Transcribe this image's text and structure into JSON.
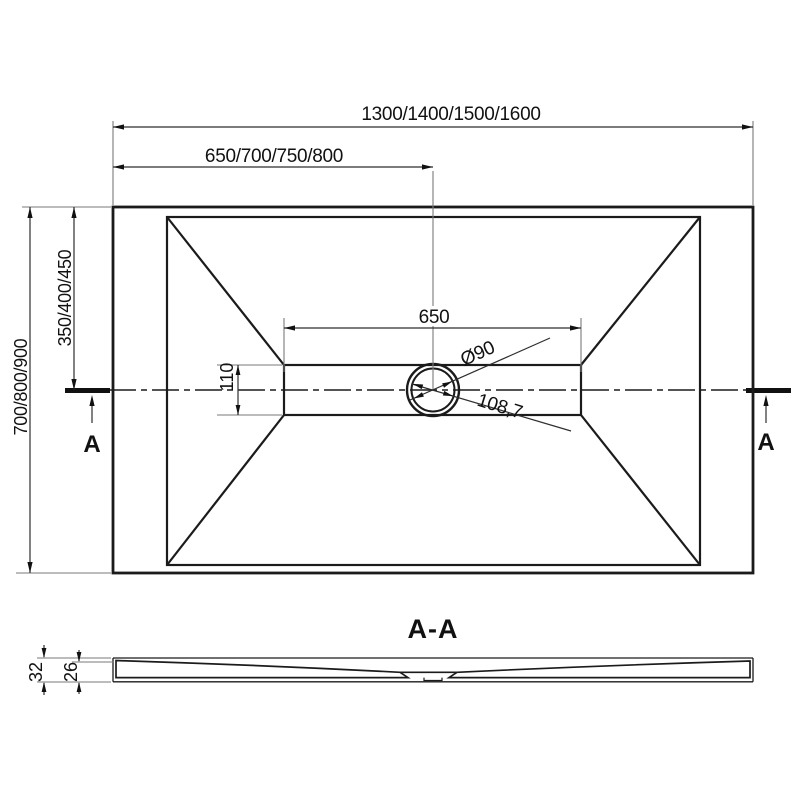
{
  "top_view": {
    "overall_width": "1300/1400/1500/1600",
    "drain_offset_x": "650/700/750/800",
    "overall_depth": "700/800/900",
    "drain_offset_y": "350/400/450",
    "channel_length": "650",
    "channel_width": "110",
    "drain_diameter": "Ø90",
    "drain_diagonal": "108,7",
    "section_marker_left": "A",
    "section_marker_right": "A"
  },
  "section_view": {
    "title": "A-A",
    "overall_height": "32",
    "base_height": "26"
  },
  "colors": {
    "line": "#1b1b1b",
    "dimension": "#2e2e2e",
    "extension": "#7a7a7a",
    "background": "#ffffff"
  }
}
